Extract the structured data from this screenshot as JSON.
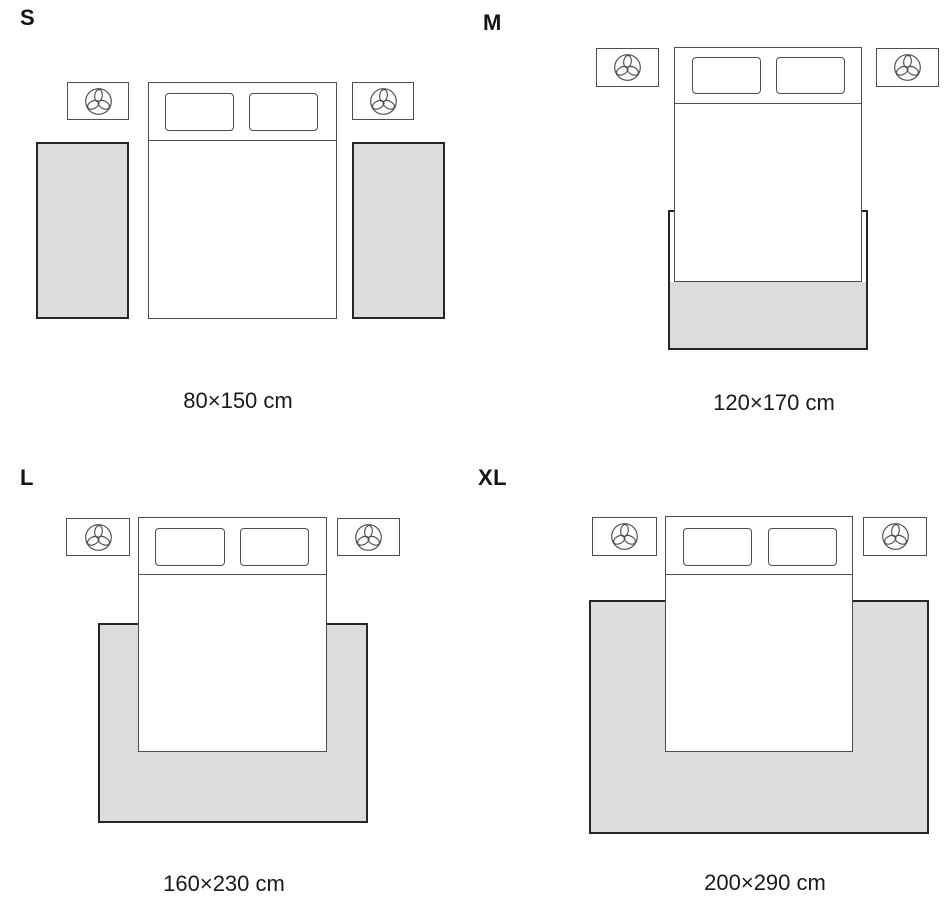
{
  "colors": {
    "rug_fill": "#dcdcdc",
    "rug_border": "#262626",
    "furniture_line": "#4d4d4d",
    "text_color": "#141414"
  },
  "icons": {
    "nightstand_icon": "plant-icon"
  },
  "sizes": [
    {
      "id": "s",
      "label": "S",
      "dimensions": "80×150 cm",
      "layout": "two side runners beside bed"
    },
    {
      "id": "m",
      "label": "M",
      "dimensions": "120×170 cm",
      "layout": "rug under foot of bed"
    },
    {
      "id": "l",
      "label": "L",
      "dimensions": "160×230 cm",
      "layout": "large rug under lower two-thirds of bed"
    },
    {
      "id": "xl",
      "label": "XL",
      "dimensions": "200×290 cm",
      "layout": "extra large rug extending past nightstands"
    }
  ]
}
